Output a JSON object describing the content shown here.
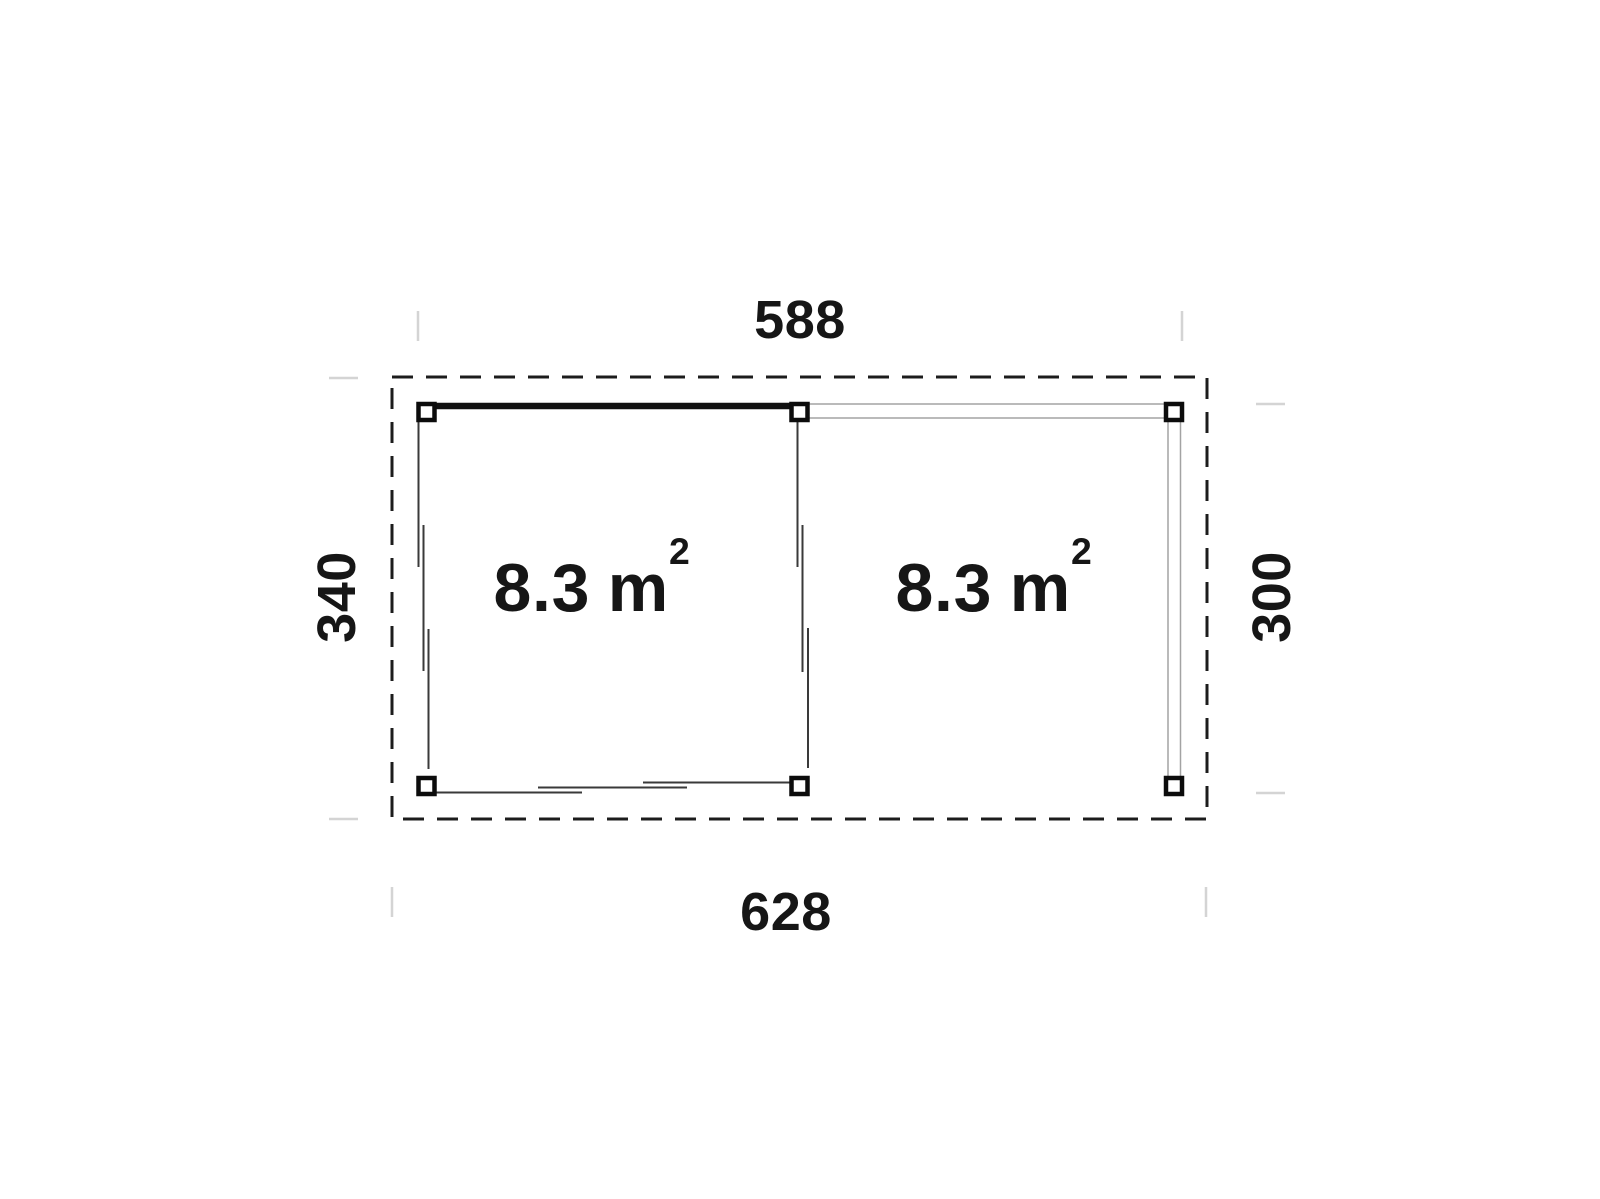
{
  "plan": {
    "dimensions": {
      "top": "588",
      "bottom": "628",
      "left": "340",
      "right": "300"
    },
    "rooms": [
      {
        "area": "8.3",
        "unit_base": "m",
        "unit_exp": "2"
      },
      {
        "area": "8.3",
        "unit_base": "m",
        "unit_exp": "2"
      }
    ],
    "colors": {
      "ink": "#161616",
      "wall_line": "#3a3a3a",
      "beam_line": "#a3a3a3",
      "tick": "#d4d4d4"
    }
  }
}
